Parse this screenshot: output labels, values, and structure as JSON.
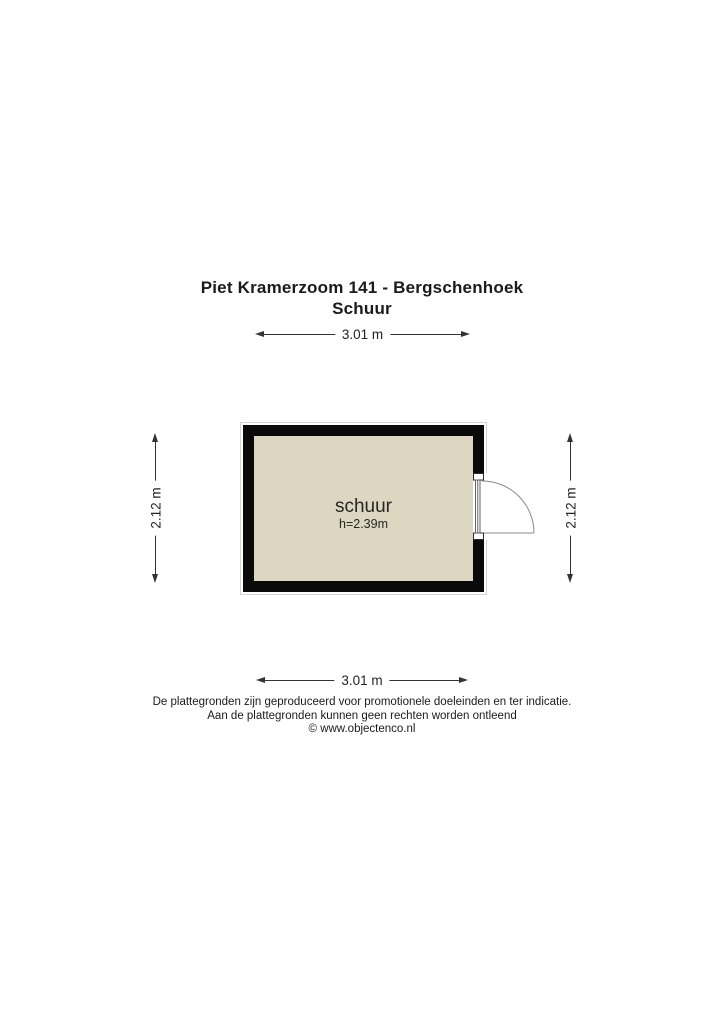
{
  "title": {
    "address": "Piet Kramerzoom 141 - Bergschenhoek",
    "subtitle": "Schuur"
  },
  "floorplan": {
    "room": {
      "name": "schuur",
      "ceiling_height": "h=2.39m"
    },
    "dimensions": {
      "top": {
        "label": "3.01 m"
      },
      "bottom": {
        "label": "3.01 m"
      },
      "left": {
        "label": "2.12 m"
      },
      "right": {
        "label": "2.12 m"
      }
    }
  },
  "footer": {
    "line1": "De plattegronden zijn geproduceerd voor promotionele doeleinden en ter indicatie.",
    "line2": "Aan de plattegronden kunnen geen rechten worden ontleend",
    "line3": "© www.objectenco.nl"
  },
  "colors": {
    "room_fill": "#ddd7c1",
    "wall": "#0a0a0a",
    "dimension_line": "#333333",
    "door_line": "#8a8a8a",
    "text": "#1b1b1b"
  }
}
